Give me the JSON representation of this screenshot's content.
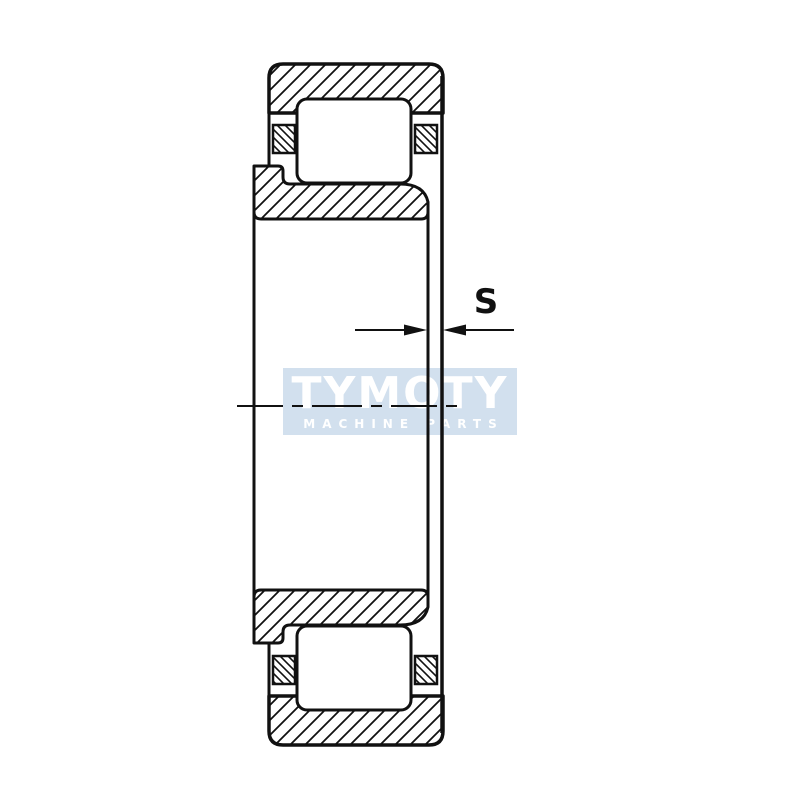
{
  "page": {
    "background_color": "#ffffff"
  },
  "watermark": {
    "brand": "TYMOTY",
    "tagline": "MACHINE PARTS",
    "bg_color": "#d2e0ee",
    "text_color": "#ffffff"
  },
  "diagram": {
    "type": "cylindrical-roller-bearing-cross-section",
    "dimension_label": "S",
    "dimension_meaning": "axial-displacement-gap-between-inner-ring-face-and-outer-ring-face",
    "line_color": "#111111",
    "hatch_style": "diagonal-section-hatching",
    "parts": [
      "outer-ring-top-section",
      "outer-ring-bottom-section",
      "inner-ring-top-section",
      "inner-ring-bottom-section",
      "roller-top",
      "roller-bottom",
      "cage-segments",
      "bearing-axis-centerline"
    ]
  }
}
